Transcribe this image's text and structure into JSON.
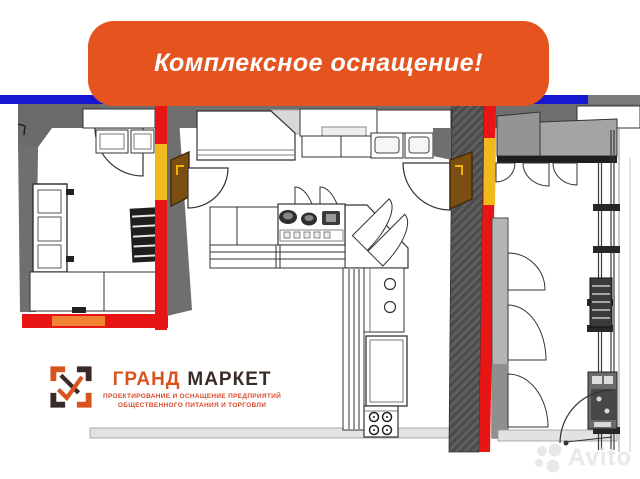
{
  "banner": {
    "text": "Комплексное оснащение!",
    "background_color": "#E5531F",
    "text_color": "#FFFFFF"
  },
  "logo": {
    "brand_word_1": "ГРАНД",
    "brand_word_2": "МАРКЕТ",
    "tagline_line_1": "ПРОЕКТИРОВАНИЕ И ОСНАЩЕНИЕ ПРЕДПРИЯТИЙ",
    "tagline_line_2": "ОБЩЕСТВЕННОГО ПИТАНИЯ И ТОРГОВЛИ",
    "accent_color": "#D9531F",
    "dark_color": "#3B2B26"
  },
  "watermark": {
    "text": "Avito",
    "color": "#E8E8E8"
  },
  "floorplan": {
    "colors": {
      "wall_gray": "#6F6F6F",
      "partition_red": "#E81515",
      "partition_yellow": "#F0B91D",
      "wall_blue": "#1717CF",
      "wall_orange_segment": "#EE8433",
      "door_brown": "#7B4E12",
      "counter_gray": "#9C9C9C",
      "floor_light": "#E2E2E2"
    }
  }
}
